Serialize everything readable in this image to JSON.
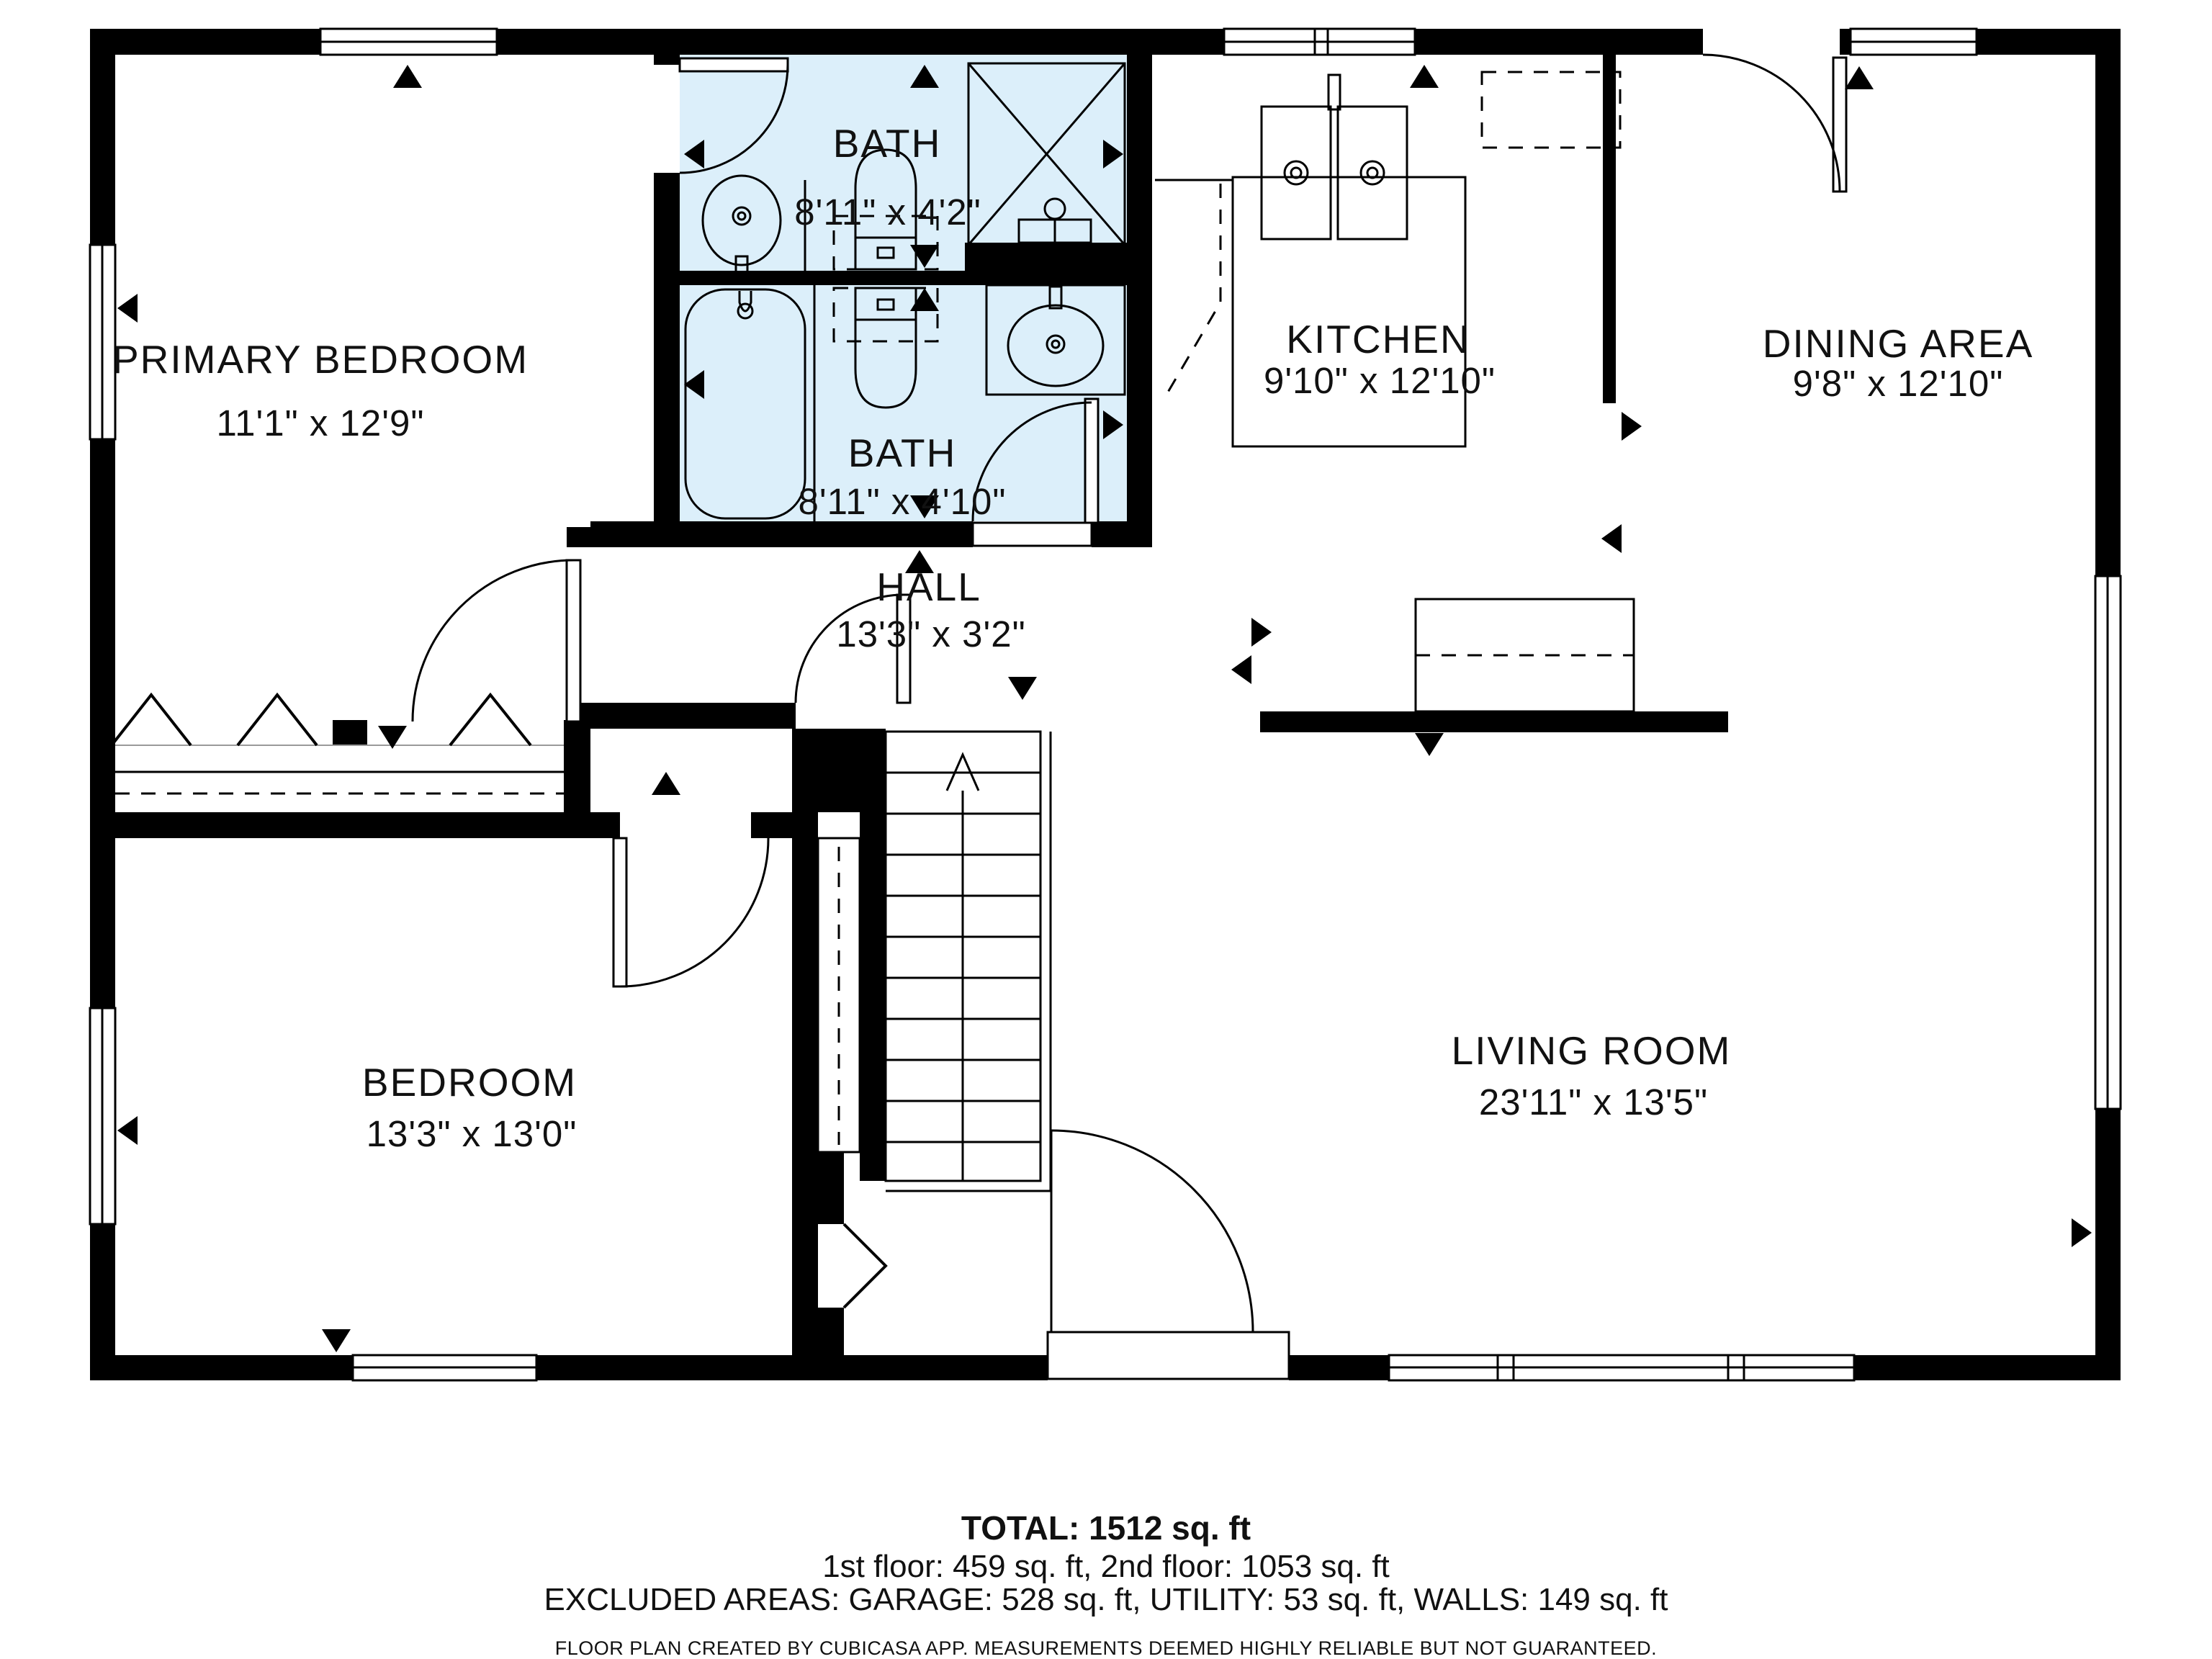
{
  "floor_plan": {
    "rooms": [
      {
        "name": "PRIMARY BEDROOM",
        "dimensions": "11'1\" x 12'9\""
      },
      {
        "name": "BATH",
        "dimensions": "8'11\" x 4'2\""
      },
      {
        "name": "BATH",
        "dimensions": "8'11\" x 4'10\""
      },
      {
        "name": "KITCHEN",
        "dimensions": "9'10\" x 12'10\""
      },
      {
        "name": "DINING AREA",
        "dimensions": "9'8\" x 12'10\""
      },
      {
        "name": "HALL",
        "dimensions": "13'3\" x 3'2\""
      },
      {
        "name": "BEDROOM",
        "dimensions": "13'3\" x 13'0\""
      },
      {
        "name": "LIVING ROOM",
        "dimensions": "23'11\" x 13'5\""
      }
    ],
    "summary": {
      "total": "TOTAL: 1512 sq. ft",
      "floors": "1st floor: 459 sq. ft, 2nd floor: 1053 sq. ft",
      "excluded": "EXCLUDED AREAS: GARAGE: 528 sq. ft, UTILITY: 53 sq. ft, WALLS: 149 sq. ft",
      "disclaimer": "FLOOR PLAN CREATED BY CUBICASA APP. MEASUREMENTS DEEMED HIGHLY RELIABLE BUT NOT GUARANTEED."
    },
    "colors": {
      "wall": "#000000",
      "bath_fill": "#dceffa",
      "background": "#ffffff"
    }
  }
}
